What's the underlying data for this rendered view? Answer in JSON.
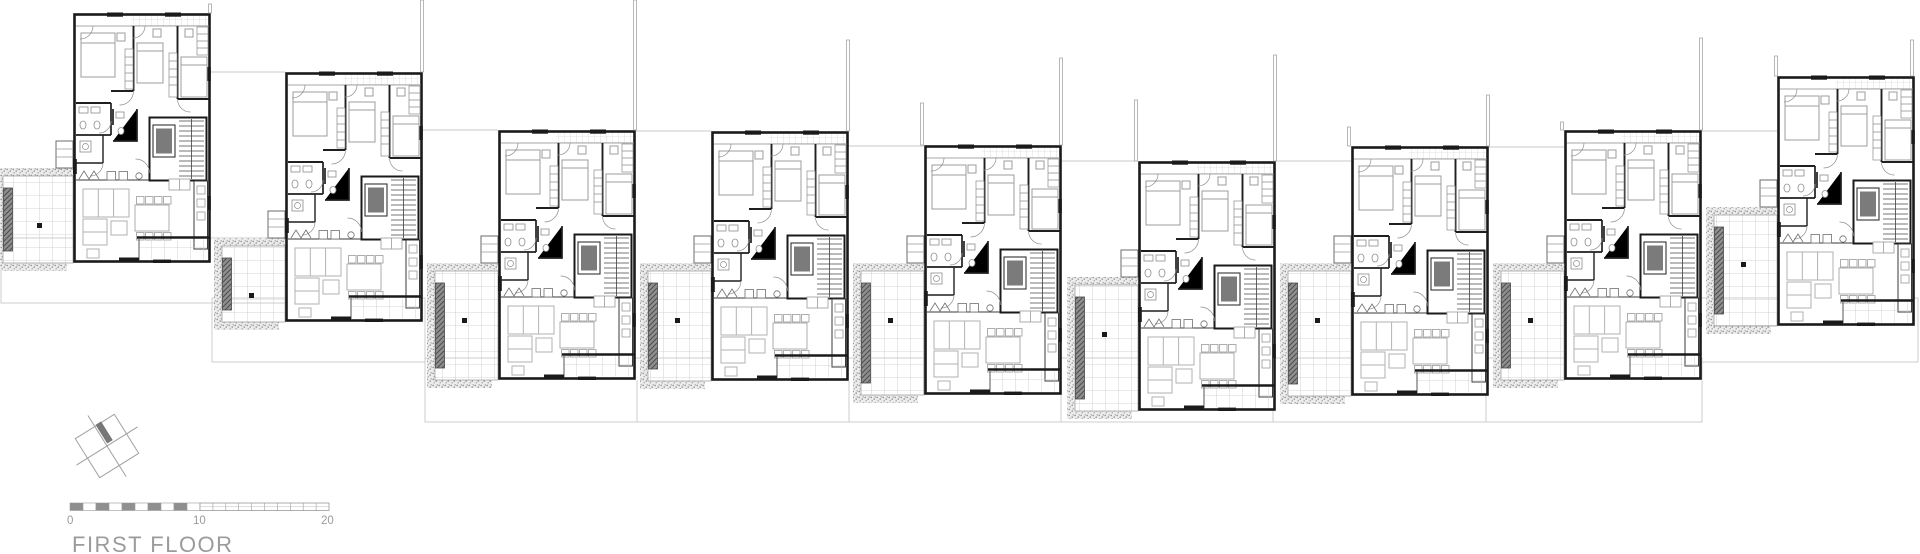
{
  "title": {
    "label": "FIRST FLOOR"
  },
  "scale_bar": {
    "labels": [
      "0",
      "10",
      "20"
    ],
    "x0": 70,
    "x10": 200,
    "x20": 329,
    "y": 503,
    "height": 7.5,
    "segments_left": 10,
    "segments_right": 10
  },
  "north_symbol": {
    "cx": 107,
    "cy": 446,
    "half": 23,
    "ext": 36,
    "rotation": -32
  },
  "colors": {
    "wall": "#1a1a1a",
    "partition": "#2a2a2a",
    "furniture": "#b2b2b2",
    "fixture": "#8d8d8d",
    "tile_grid": "#c7c7c7",
    "stipple": "#9e9e9e",
    "planter": "#7d7d7d",
    "planter_hatch": "#4f4f4f",
    "party_line": "#9a9a9a",
    "faint_line": "#c9c9c9",
    "elevator_fill": "#7b7b7b",
    "text": "#9b9b9b",
    "scale_dark": "#8f8f8f"
  },
  "unit_size": {
    "w": 137,
    "h": 250,
    "terrace_w": 63
  },
  "units": [
    {
      "id": "unit-1",
      "x": 73,
      "y": 13,
      "terrace_top": 168,
      "terrace_left": 3
    },
    {
      "id": "unit-2",
      "x": 285,
      "y": 72,
      "terrace_top": 238,
      "terrace_left": 222
    },
    {
      "id": "unit-3",
      "x": 498,
      "y": 130,
      "terrace_top": 263,
      "terrace_left": 435
    },
    {
      "id": "unit-4",
      "x": 711,
      "y": 131,
      "terrace_top": 263,
      "terrace_left": 648
    },
    {
      "id": "unit-5",
      "x": 924,
      "y": 145,
      "terrace_top": 263,
      "terrace_left": 861
    },
    {
      "id": "unit-6",
      "x": 1138,
      "y": 161,
      "terrace_top": 277,
      "terrace_left": 1075
    },
    {
      "id": "unit-7",
      "x": 1351,
      "y": 146,
      "terrace_top": 263,
      "terrace_left": 1288
    },
    {
      "id": "unit-8",
      "x": 1564,
      "y": 130,
      "terrace_top": 263,
      "terrace_left": 1501
    },
    {
      "id": "unit-9",
      "x": 1777,
      "y": 76,
      "terrace_top": 207,
      "terrace_left": 1714
    }
  ],
  "party_lines": [
    {
      "x": 210,
      "y1": 4,
      "y2": 13
    },
    {
      "x": 422,
      "y1": 0,
      "y2": 72
    },
    {
      "x": 635,
      "y1": 0,
      "y2": 130
    },
    {
      "x": 848,
      "y1": 40,
      "y2": 131
    },
    {
      "x": 922,
      "y1": 103,
      "y2": 145
    },
    {
      "x": 1061,
      "y1": 58,
      "y2": 145
    },
    {
      "x": 1136,
      "y1": 100,
      "y2": 161
    },
    {
      "x": 1275,
      "y1": 55,
      "y2": 161
    },
    {
      "x": 1349,
      "y1": 127,
      "y2": 146
    },
    {
      "x": 1488,
      "y1": 95,
      "y2": 146
    },
    {
      "x": 1562,
      "y1": 122,
      "y2": 130
    },
    {
      "x": 1701,
      "y1": 38,
      "y2": 130
    },
    {
      "x": 1776,
      "y1": 56,
      "y2": 76
    },
    {
      "x": 1912,
      "y1": 40,
      "y2": 76
    }
  ],
  "gap_lines": [
    {
      "x1": 210,
      "x2": 285,
      "y": 72
    },
    {
      "x1": 422,
      "x2": 498,
      "y": 130
    },
    {
      "x1": 635,
      "x2": 711,
      "y": 131
    },
    {
      "x1": 848,
      "x2": 924,
      "y": 146
    },
    {
      "x1": 1061,
      "x2": 1138,
      "y": 161
    },
    {
      "x1": 1275,
      "x2": 1351,
      "y": 161
    },
    {
      "x1": 1488,
      "x2": 1564,
      "y": 147
    },
    {
      "x1": 1701,
      "x2": 1777,
      "y": 131
    }
  ],
  "lot_rects": [
    {
      "x": 1,
      "y": 238,
      "w": 344,
      "h": 65
    },
    {
      "x": 212,
      "y": 298,
      "w": 213,
      "h": 64
    },
    {
      "x": 425,
      "y": 358,
      "w": 1277,
      "h": 64
    },
    {
      "x": 1700,
      "y": 298,
      "w": 218,
      "h": 64
    }
  ],
  "lot_dividers": [
    {
      "x": 637,
      "y1": 380,
      "y2": 422
    },
    {
      "x": 849,
      "y1": 381,
      "y2": 422
    },
    {
      "x": 1061,
      "y1": 395,
      "y2": 422
    },
    {
      "x": 1273,
      "y1": 411,
      "y2": 422
    },
    {
      "x": 1486,
      "y1": 396,
      "y2": 422
    }
  ]
}
